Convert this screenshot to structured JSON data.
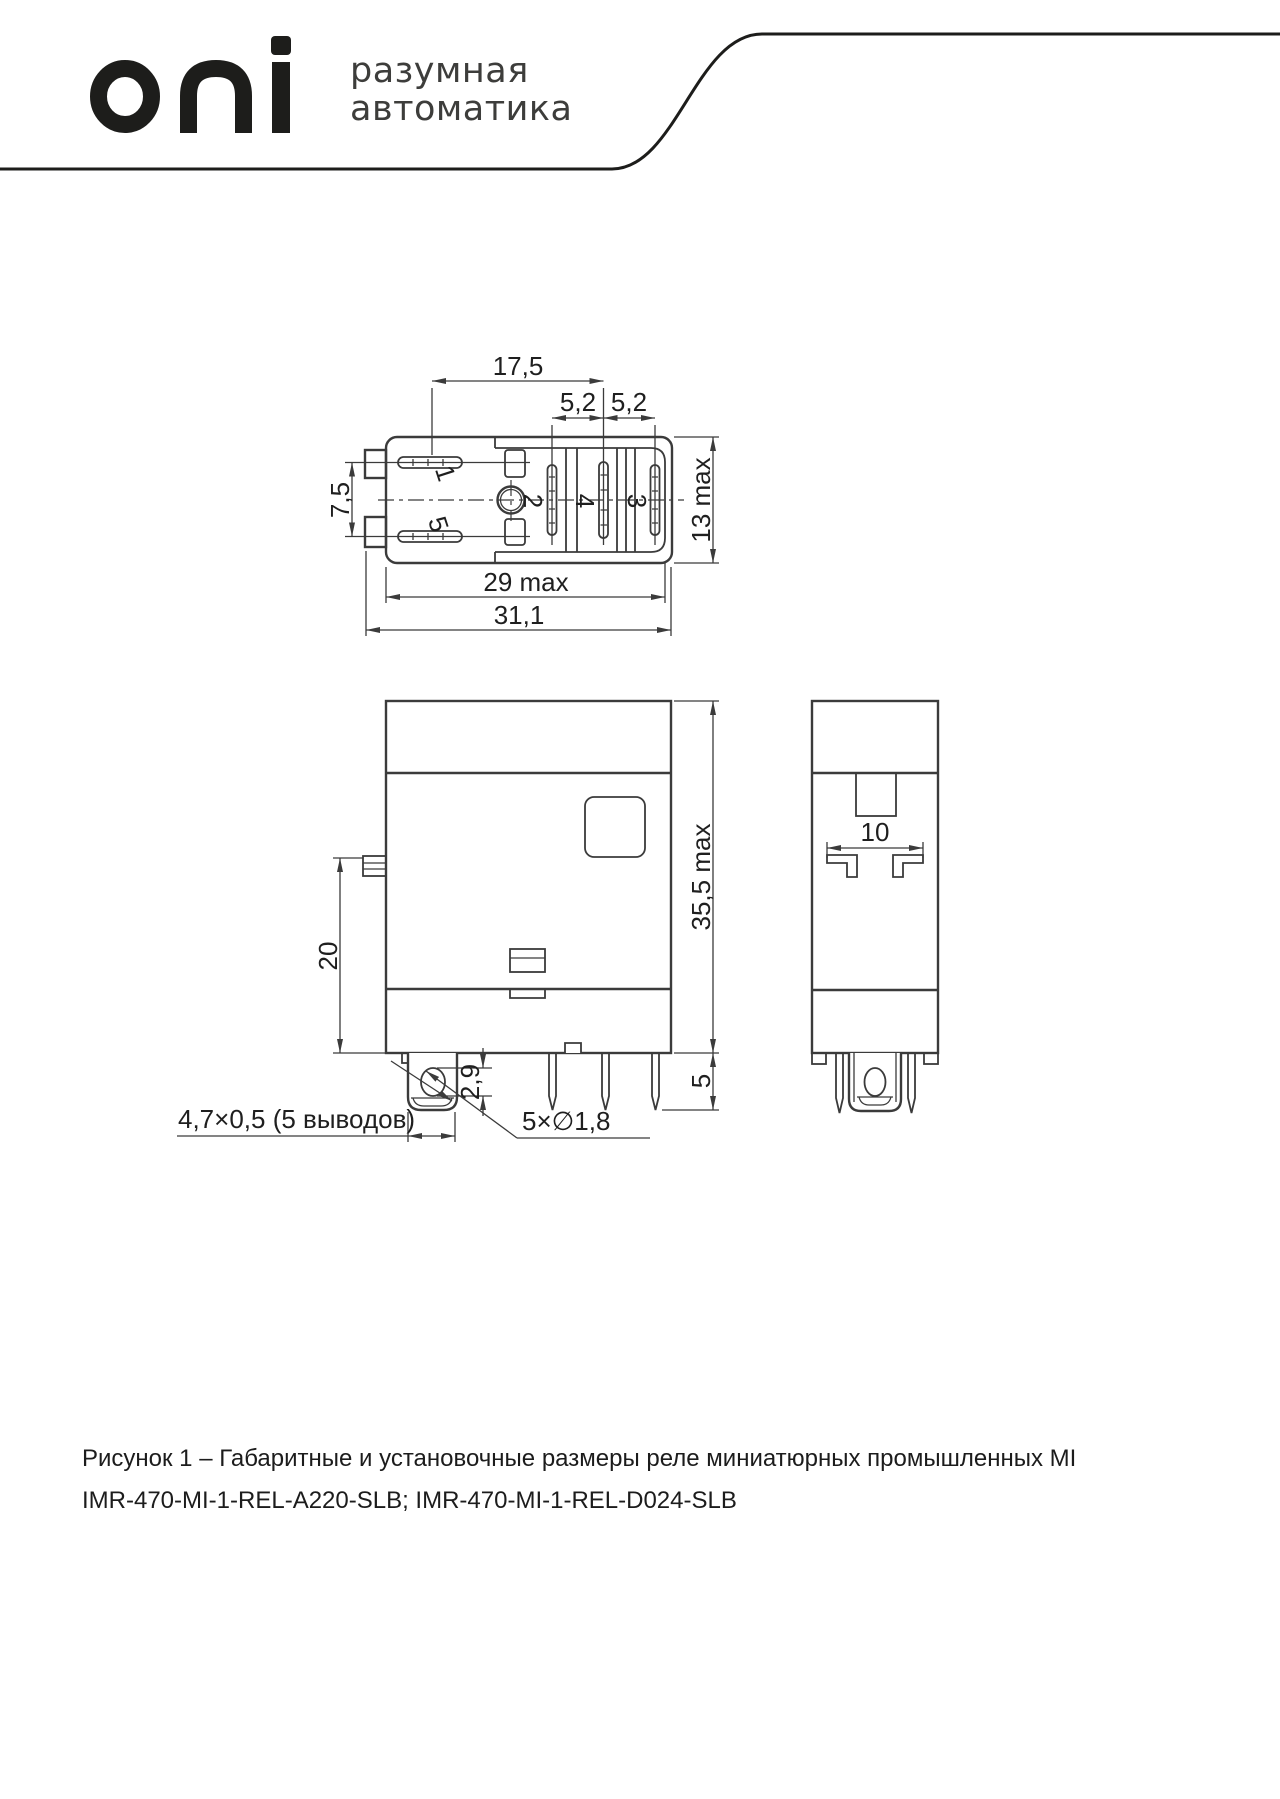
{
  "header": {
    "logo": "oni",
    "tagline1": "разумная",
    "tagline2": "автоматика"
  },
  "drawing": {
    "top_view": {
      "dim_17_5": "17,5",
      "dim_5_2_left": "5,2",
      "dim_5_2_right": "5,2",
      "dim_7_5": "7,5",
      "dim_13_max": "13 max",
      "dim_29_max": "29 max",
      "dim_31_1": "31,1",
      "pin_1": "1",
      "pin_5": "5",
      "pin_2": "2",
      "pin_4": "4",
      "pin_3": "3"
    },
    "front_view": {
      "dim_20": "20",
      "dim_35_5_max": "35,5 max",
      "dim_2_9": "2,9",
      "dim_5": "5",
      "label_blade": "4,7×0,5 (5 выводов)",
      "label_holes": "5×∅1,8"
    },
    "side_view": {
      "dim_10": "10"
    }
  },
  "caption": {
    "line1": "Рисунок 1 – Габаритные и установочные размеры реле миниатюрных промышленных MI",
    "line2": "IMR-470-MI-1-REL-A220-SLB; IMR-470-MI-1-REL-D024-SLB"
  },
  "colors": {
    "line": "#3b3b3b",
    "text": "#1f1f1f",
    "logo": "#1d1d1b"
  }
}
